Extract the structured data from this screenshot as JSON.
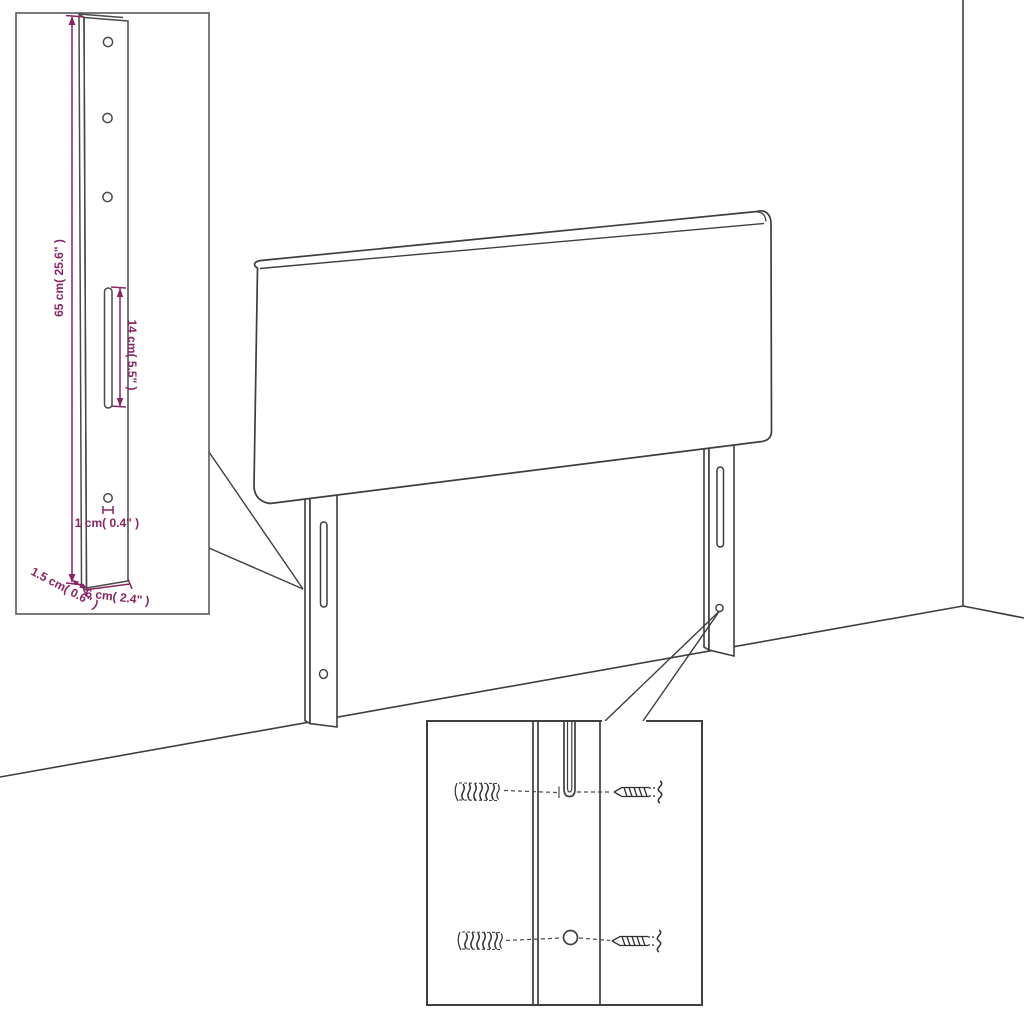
{
  "colors": {
    "line": "#3e3e3e",
    "dimension": "#8a2462",
    "inset_border": "#5a5a5a",
    "background": "#ffffff"
  },
  "leg_detail": {
    "height_label": "65 cm( 25.6\" )",
    "slot_label": "14 cm( 5.5\" )",
    "hole_label": "1 cm( 0.4\" )",
    "depth_label": "1.5 cm( 0.6\" )",
    "width_label": "6 cm( 2.4\" )"
  }
}
